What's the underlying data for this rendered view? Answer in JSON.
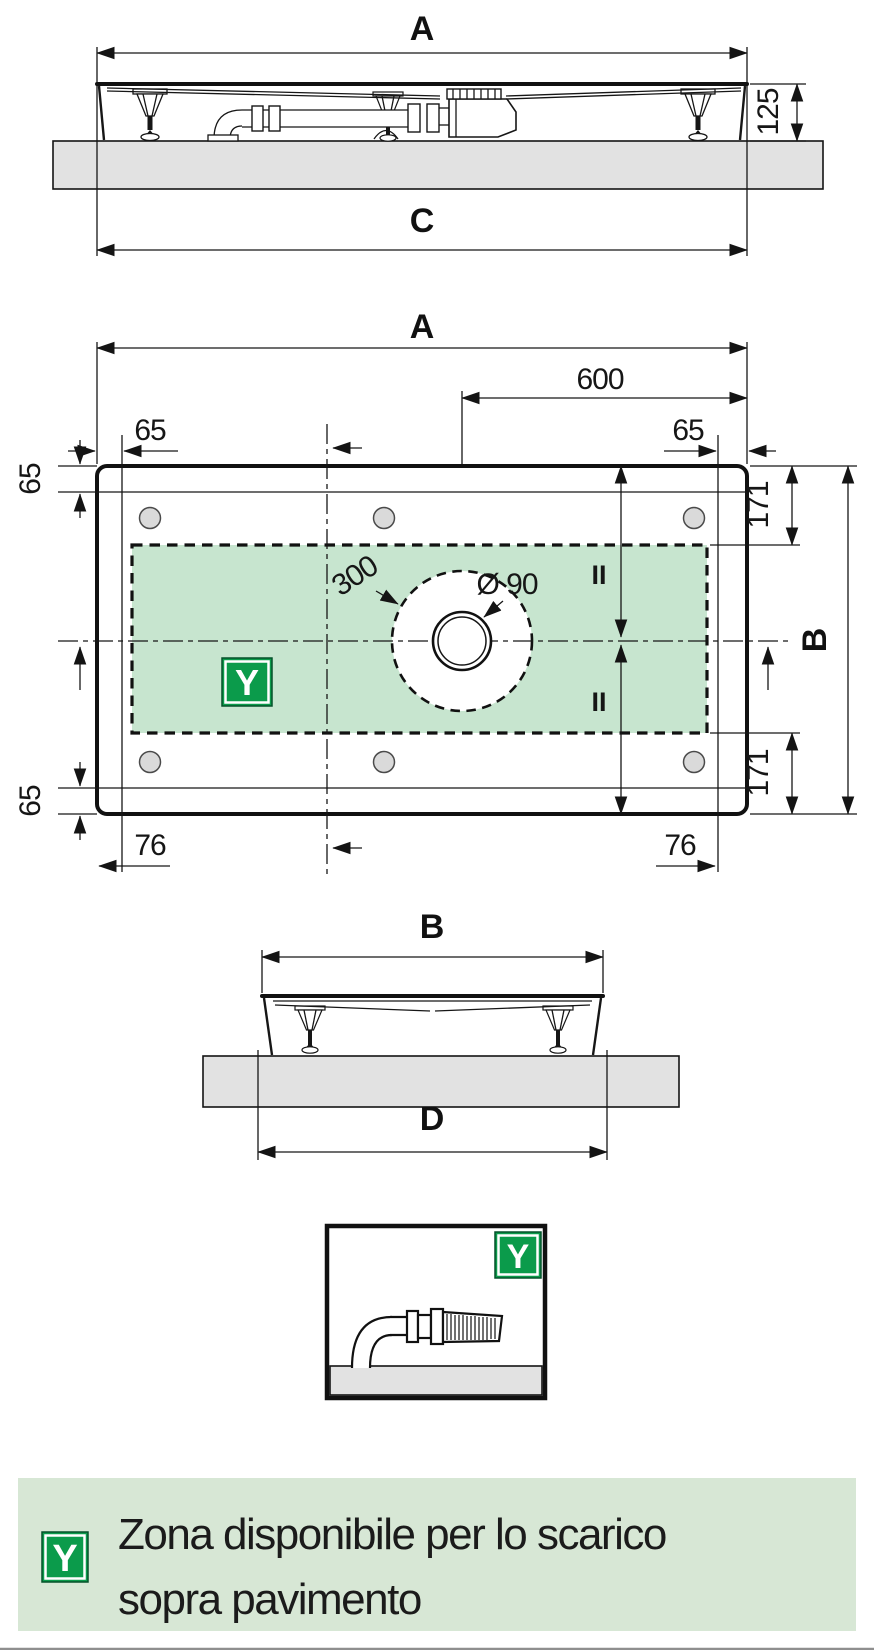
{
  "colors": {
    "zone_green": "#c7e5cf",
    "legend_band": "#d7e7d5",
    "badge_green": "#0b9b4b",
    "badge_border": "#04522a",
    "slab_gray": "#e2e2e2",
    "line": "#141414",
    "divider_gray": "#8f8f8f"
  },
  "side_top": {
    "width_top": "A",
    "height": "125",
    "width_bottom": "C"
  },
  "plan": {
    "width": "A",
    "drain_offset": "600",
    "rim_top_left": "65",
    "rim_top_right": "65",
    "rim_left_top": "65",
    "rim_left_bottom": "65",
    "rim_bottom_left": "76",
    "rim_bottom_right": "76",
    "zone_top": "171",
    "zone_bottom": "171",
    "height": "B",
    "zone_circle": "300",
    "drain_diameter": "Ø 90",
    "equal_top": "II",
    "equal_bottom": "II",
    "zone_badge": "Y"
  },
  "side_bottom": {
    "width_top": "B",
    "width_bottom": "D"
  },
  "detail": {
    "badge": "Y"
  },
  "legend": {
    "badge": "Y",
    "line1": "Zona disponibile per lo scarico",
    "line2": "sopra pavimento"
  }
}
